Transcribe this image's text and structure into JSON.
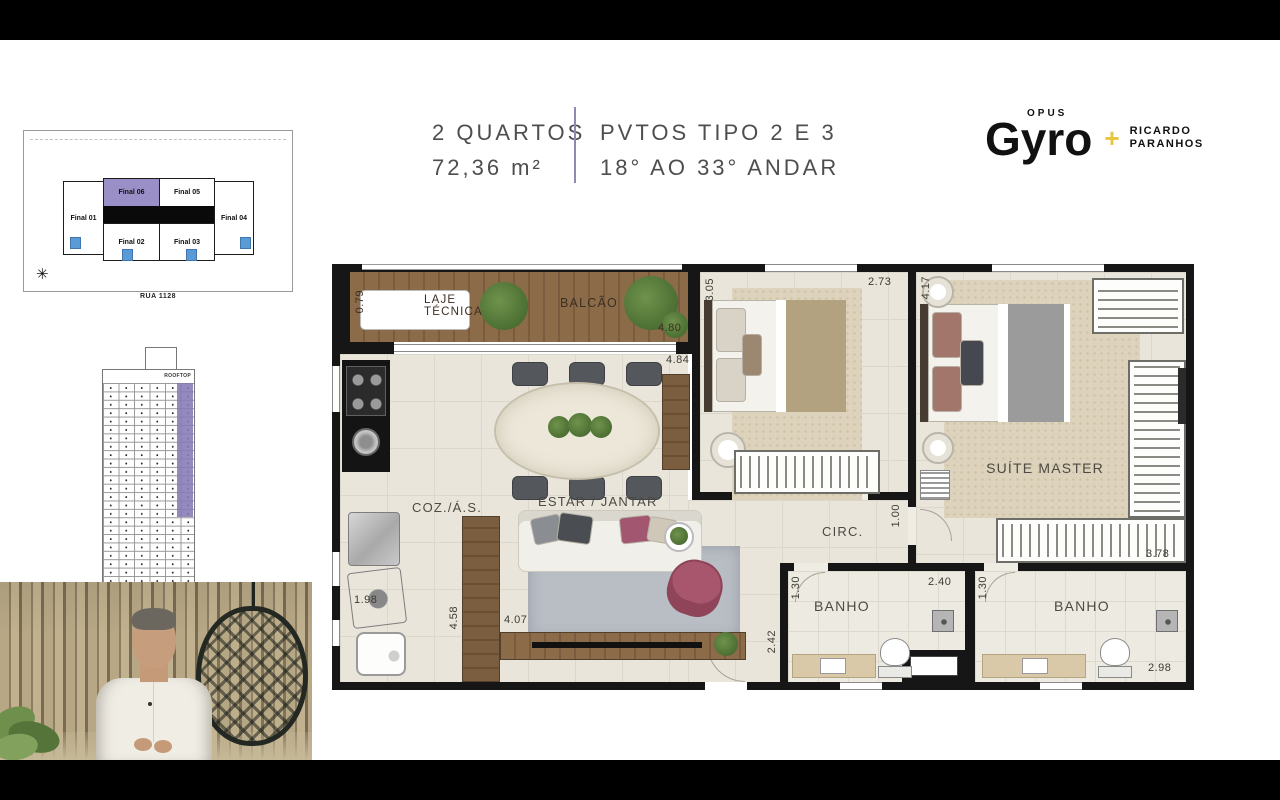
{
  "colors": {
    "accent_purple": "#9b8fc7",
    "plus_yellow": "#e7c63d",
    "unit_blue": "#5b9bd5"
  },
  "header": {
    "unit_type": "2 QUARTOS",
    "area": "72,36 m²",
    "pavements": "PVTOS TIPO 2 E 3",
    "floors": "18° AO 33° ANDAR"
  },
  "logo": {
    "opus": "OPUS",
    "brand": "Gyro",
    "plus": "+",
    "partner_line1": "RICARDO",
    "partner_line2": "PARANHOS"
  },
  "keyplan": {
    "street": "RUA 1128",
    "units": [
      {
        "label": "Final 01",
        "highlighted": false
      },
      {
        "label": "Final 02",
        "highlighted": false
      },
      {
        "label": "Final 03",
        "highlighted": false
      },
      {
        "label": "Final 04",
        "highlighted": false
      },
      {
        "label": "Final 05",
        "highlighted": false
      },
      {
        "label": "Final 06",
        "highlighted": true
      }
    ]
  },
  "tower": {
    "rooftop_label": "ROOFTOP"
  },
  "plan": {
    "labels": {
      "laje_tecnica": "LAJE TÉCNICA",
      "balcao": "BALCÃO",
      "coz": "COZ./Á.S.",
      "estar_jantar": "ESTAR / JANTAR",
      "circ": "CIRC.",
      "banho_1": "BANHO",
      "banho_2": "BANHO",
      "suite_master": "SUÍTE MASTER"
    },
    "dims": {
      "balcao_depth": "0.79",
      "balcao_width": "4.80",
      "living_width": "4.84",
      "bedroom1_depth": "3.05",
      "bedroom1_width": "2.73",
      "suite_depth": "4.17",
      "suite_width": "3.78",
      "circ_width": "1.00",
      "banho1_width": "2.40",
      "banho1_depth": "1.30",
      "banho2_depth": "1.30",
      "banho2_width": "2.98",
      "service_width": "1.98",
      "kitchen_length": "4.58",
      "living_length": "4.07",
      "banho1_outer": "2.42"
    }
  }
}
